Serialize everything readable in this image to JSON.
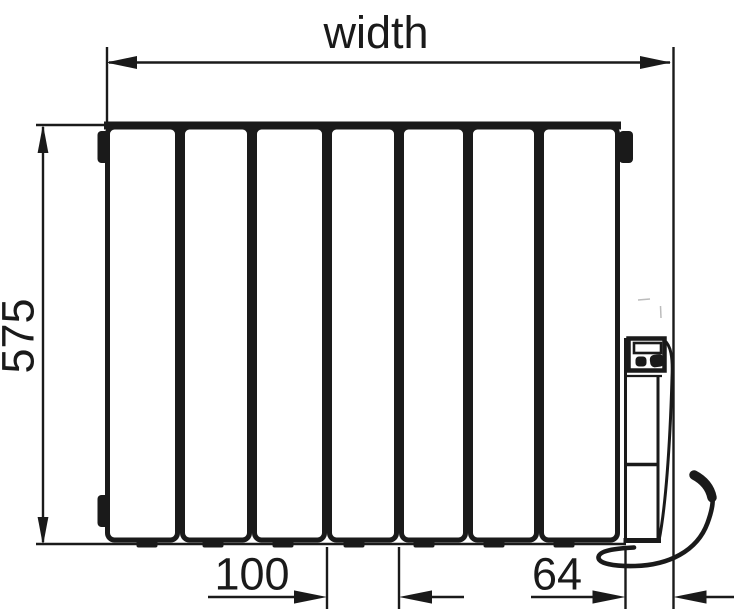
{
  "colors": {
    "ink": "#1a1a1a",
    "background": "#ffffff"
  },
  "radiator": {
    "section_count": 7
  },
  "dimensions": {
    "width": {
      "label": "width"
    },
    "height": {
      "label": "575"
    },
    "section_pitch": {
      "label": "100"
    },
    "control_width": {
      "label": "64"
    }
  }
}
